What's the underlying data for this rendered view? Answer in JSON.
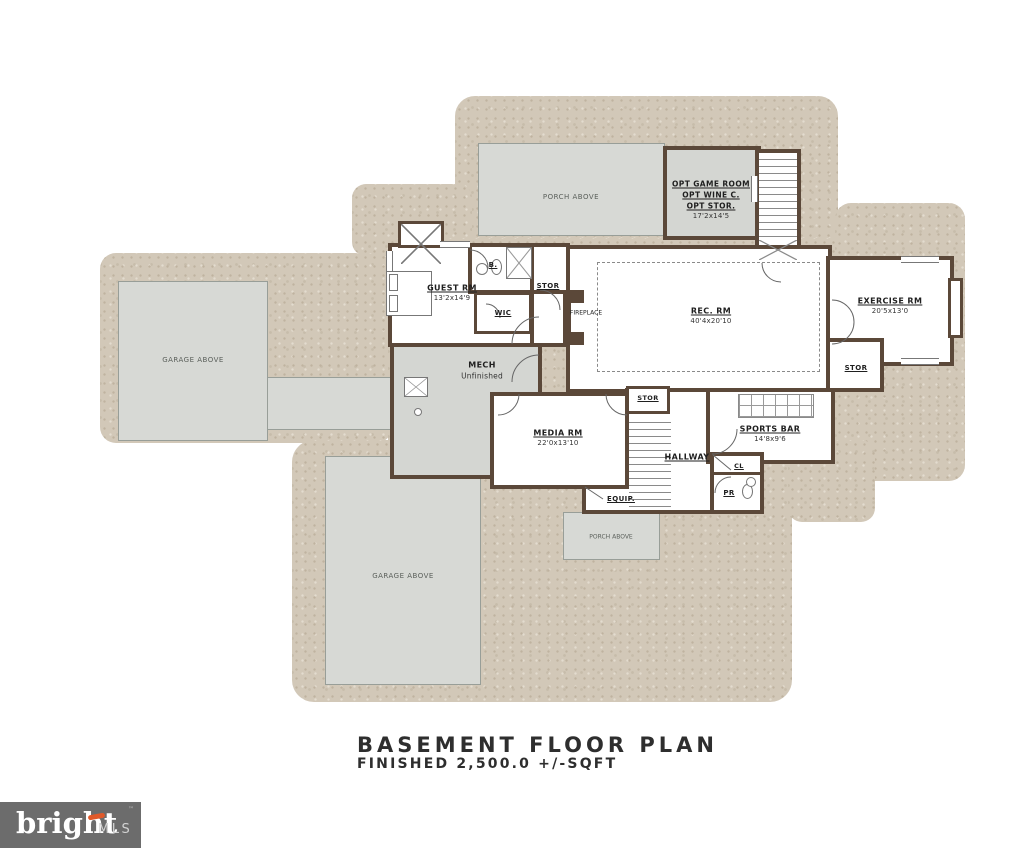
{
  "title_block": {
    "title": "BASEMENT FLOOR PLAN",
    "subtitle": "FINISHED 2,500.0  +/-SQFT"
  },
  "watermark": {
    "brand": "bright",
    "mls": "MLS",
    "tm": "™"
  },
  "colors": {
    "wall": "#5b4839",
    "terrain": "#d2c8b8",
    "above_fill": "#d7d9d5",
    "paper": "#ffffff",
    "watermark_bg": "#6c6c6c",
    "watermark_accent": "#e0592a"
  },
  "areas": {
    "porch_above_top": "PORCH ABOVE",
    "garage_above_left": "GARAGE ABOVE",
    "garage_above_bottom": "GARAGE ABOVE",
    "porch_above_bottom": "PORCH ABOVE"
  },
  "rooms": {
    "opt_game": {
      "line1": "OPT GAME ROOM",
      "line2": "OPT WINE C.",
      "line3": "OPT STOR.",
      "dims": "17'2x14'5"
    },
    "guest": {
      "label": "GUEST RM",
      "dims": "13'2x14'9"
    },
    "bath": {
      "label": "B."
    },
    "wic": {
      "label": "WIC"
    },
    "stor_guest": {
      "label": "STOR"
    },
    "fireplace": {
      "label": "FIREPLACE"
    },
    "rec": {
      "label": "REC. RM",
      "dims": "40'4x20'10"
    },
    "exercise": {
      "label": "EXERCISE RM",
      "dims": "20'5x13'0"
    },
    "stor_exercise": {
      "label": "STOR"
    },
    "mech": {
      "label": "MECH",
      "sub": "Unfinished"
    },
    "media": {
      "label": "MEDIA RM",
      "dims": "22'0x13'10"
    },
    "stor_hallway": {
      "label": "STOR"
    },
    "hallway": {
      "label": "HALLWAY"
    },
    "sports_bar": {
      "label": "SPORTS BAR",
      "dims": "14'8x9'6"
    },
    "closet": {
      "label": "CL"
    },
    "powder": {
      "label": "PR"
    },
    "equip": {
      "label": "EQUIP."
    }
  }
}
